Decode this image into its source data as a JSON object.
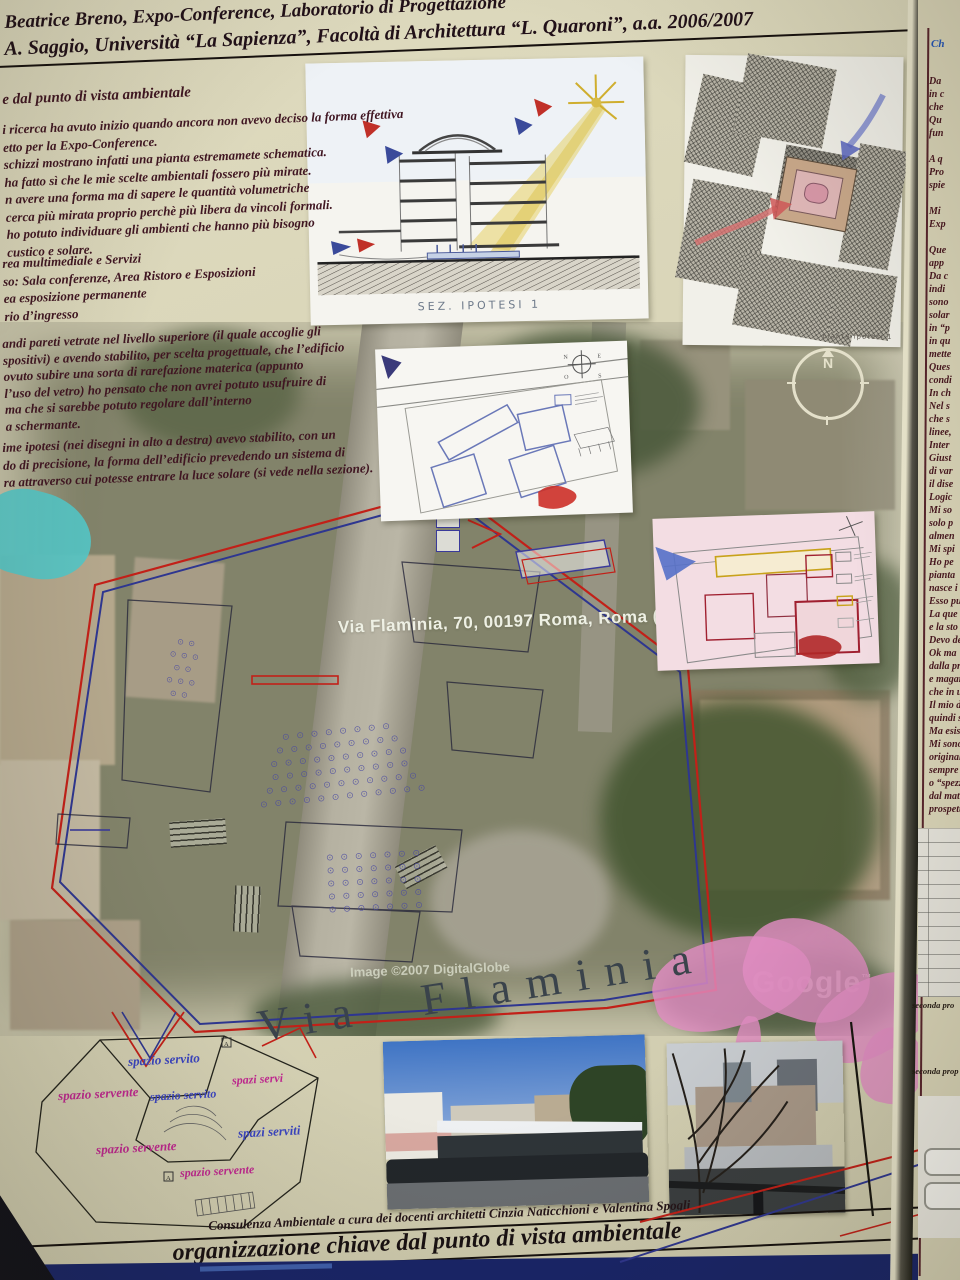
{
  "header": {
    "line1": "Beatrice Breno, Expo-Conference, Laboratorio di Progettazione",
    "line2": "A. Saggio, Università “La Sapienza”, Facoltà di Architettura “L. Quaroni”, a.a. 2006/2007"
  },
  "left_column": {
    "heading": "e dal punto di vista ambientale",
    "para1": [
      "i ricerca ha avuto inizio quando ancora non avevo deciso la forma effettiva",
      "etto per la Expo-Conference.",
      "schizzi mostrano infatti una pianta estremamete schematica.",
      "ha fatto sì che le mie scelte ambientali fossero più mirate.",
      "n avere una forma ma di sapere le quantità volumetriche",
      "cerca più mirata proprio perchè più libera da vincoli formali.",
      "ho potuto individuare gli ambienti che hanno più bisogno",
      "custico e solare."
    ],
    "program": [
      "rea multimediale e Servizi",
      "so: Sala conferenze, Area Ristoro e Esposizioni",
      "ea esposizione permanente",
      "rio d’ingresso"
    ],
    "para2": [
      "andi pareti vetrate nel livello superiore (il quale accoglie gli",
      "spositivi) e avendo stabilito, per scelta progettuale, che l’edificio",
      "ovuto subire una sorta di rarefazione materica (appunto",
      "l’uso del vetro) ho pensato che non avrei potuto usufruire di",
      "ma che si sarebbe potuto regolare dall’interno",
      "a schermante."
    ],
    "para3": [
      "ime ipotesi (nei disegni in alto a destra) avevo stabilito, con un",
      "do di precisione, la forma dell’edificio prevedendo un sistema di",
      "ra attraverso cui potesse entrare la luce solare (si vede nella sezione)."
    ]
  },
  "section_sketch": {
    "caption": "SEZ. IPOTESI 1"
  },
  "plan_sketch": {
    "caption": "pianta ipotesi 1"
  },
  "schematic_sketch": {
    "compass_n": "N",
    "compass_e": "E",
    "compass_s": "S",
    "compass_o": "O"
  },
  "map": {
    "address_label": "Via Flaminia, 70, 00197 Roma, Roma (L",
    "copyright": "Image ©2007 DigitalGlobe",
    "watermark": "Google",
    "watermark_tm": "™",
    "compass_letter": "N",
    "street_label_big": "Via Flaminia",
    "seats_arc": [
      "⊙ ⊙ ⊙ ⊙ ⊙ ⊙ ⊙ ⊙",
      "⊙ ⊙ ⊙ ⊙ ⊙ ⊙ ⊙ ⊙ ⊙",
      "⊙ ⊙ ⊙ ⊙ ⊙ ⊙ ⊙ ⊙ ⊙ ⊙",
      "⊙ ⊙ ⊙ ⊙ ⊙ ⊙ ⊙ ⊙ ⊙ ⊙",
      "⊙ ⊙ ⊙ ⊙ ⊙ ⊙ ⊙ ⊙ ⊙ ⊙ ⊙",
      "⊙ ⊙ ⊙ ⊙ ⊙ ⊙ ⊙ ⊙ ⊙ ⊙ ⊙ ⊙"
    ],
    "seats_block": [
      "⊙ ⊙ ⊙ ⊙ ⊙ ⊙ ⊙",
      "⊙ ⊙ ⊙ ⊙ ⊙ ⊙ ⊙",
      "⊙ ⊙ ⊙ ⊙ ⊙ ⊙ ⊙",
      "⊙ ⊙ ⊙ ⊙ ⊙ ⊙ ⊙",
      "⊙ ⊙ ⊙ ⊙ ⊙ ⊙ ⊙"
    ],
    "seats_left": [
      "⊙ ⊙",
      "⊙ ⊙ ⊙",
      "⊙ ⊙",
      "⊙ ⊙ ⊙",
      "⊙ ⊙"
    ]
  },
  "spazi_plan": {
    "labels": [
      "spazio servito",
      "spazi servi",
      "spazio servente",
      "spazio servito",
      "spazi serviti",
      "spazio servente",
      "spazio servente"
    ],
    "marker_letter": "A"
  },
  "footer": {
    "credit": "Consulenza Ambientale a cura dei docenti architetti Cinzia Naticchioni e Valentina Spogli",
    "title": "organizzazione chiave dal punto di vista ambientale"
  },
  "right_panel": {
    "heading": "Ch",
    "fragments": [
      "Da",
      "in c",
      "che",
      "Qu",
      "fun",
      "",
      "A q",
      "Pro",
      "spie",
      "",
      "Mi",
      "Exp",
      "",
      "Que",
      "app",
      "Da c",
      "indi",
      "sono",
      "solar",
      "in “p",
      "in qu",
      "mette",
      "Ques",
      "condi",
      "In ch",
      "Nel s",
      "che s",
      "linee,",
      "Inter",
      "Giust",
      "di var",
      "il dise",
      "Logic",
      "Mi so",
      "solo p",
      "almen",
      "Mi spi",
      "Ho pe",
      "pianta",
      "nasce i",
      "Esso pu",
      "La que",
      "e la sto",
      "Devo de",
      "Ok ma",
      "dalla pr",
      "e magar",
      "che in u",
      "Il mio di",
      "quindi su",
      "Ma esiste",
      "Mi sono",
      "originale",
      "sempre u",
      "o “spezze",
      "dal matri",
      "prospetto"
    ],
    "caption1": "seconda pro",
    "caption2": "seconda prop"
  },
  "colors": {
    "site_outline_red": "#c22018",
    "site_outline_blue": "#2e3690",
    "label_blue": "#3a44c0",
    "label_magenta": "#c02890",
    "poster_background": "#d8d4b6",
    "bottom_bar_navy": "#18246a",
    "highlight_cyan": "#55c6c6",
    "highlight_pink": "#e08cc2"
  }
}
